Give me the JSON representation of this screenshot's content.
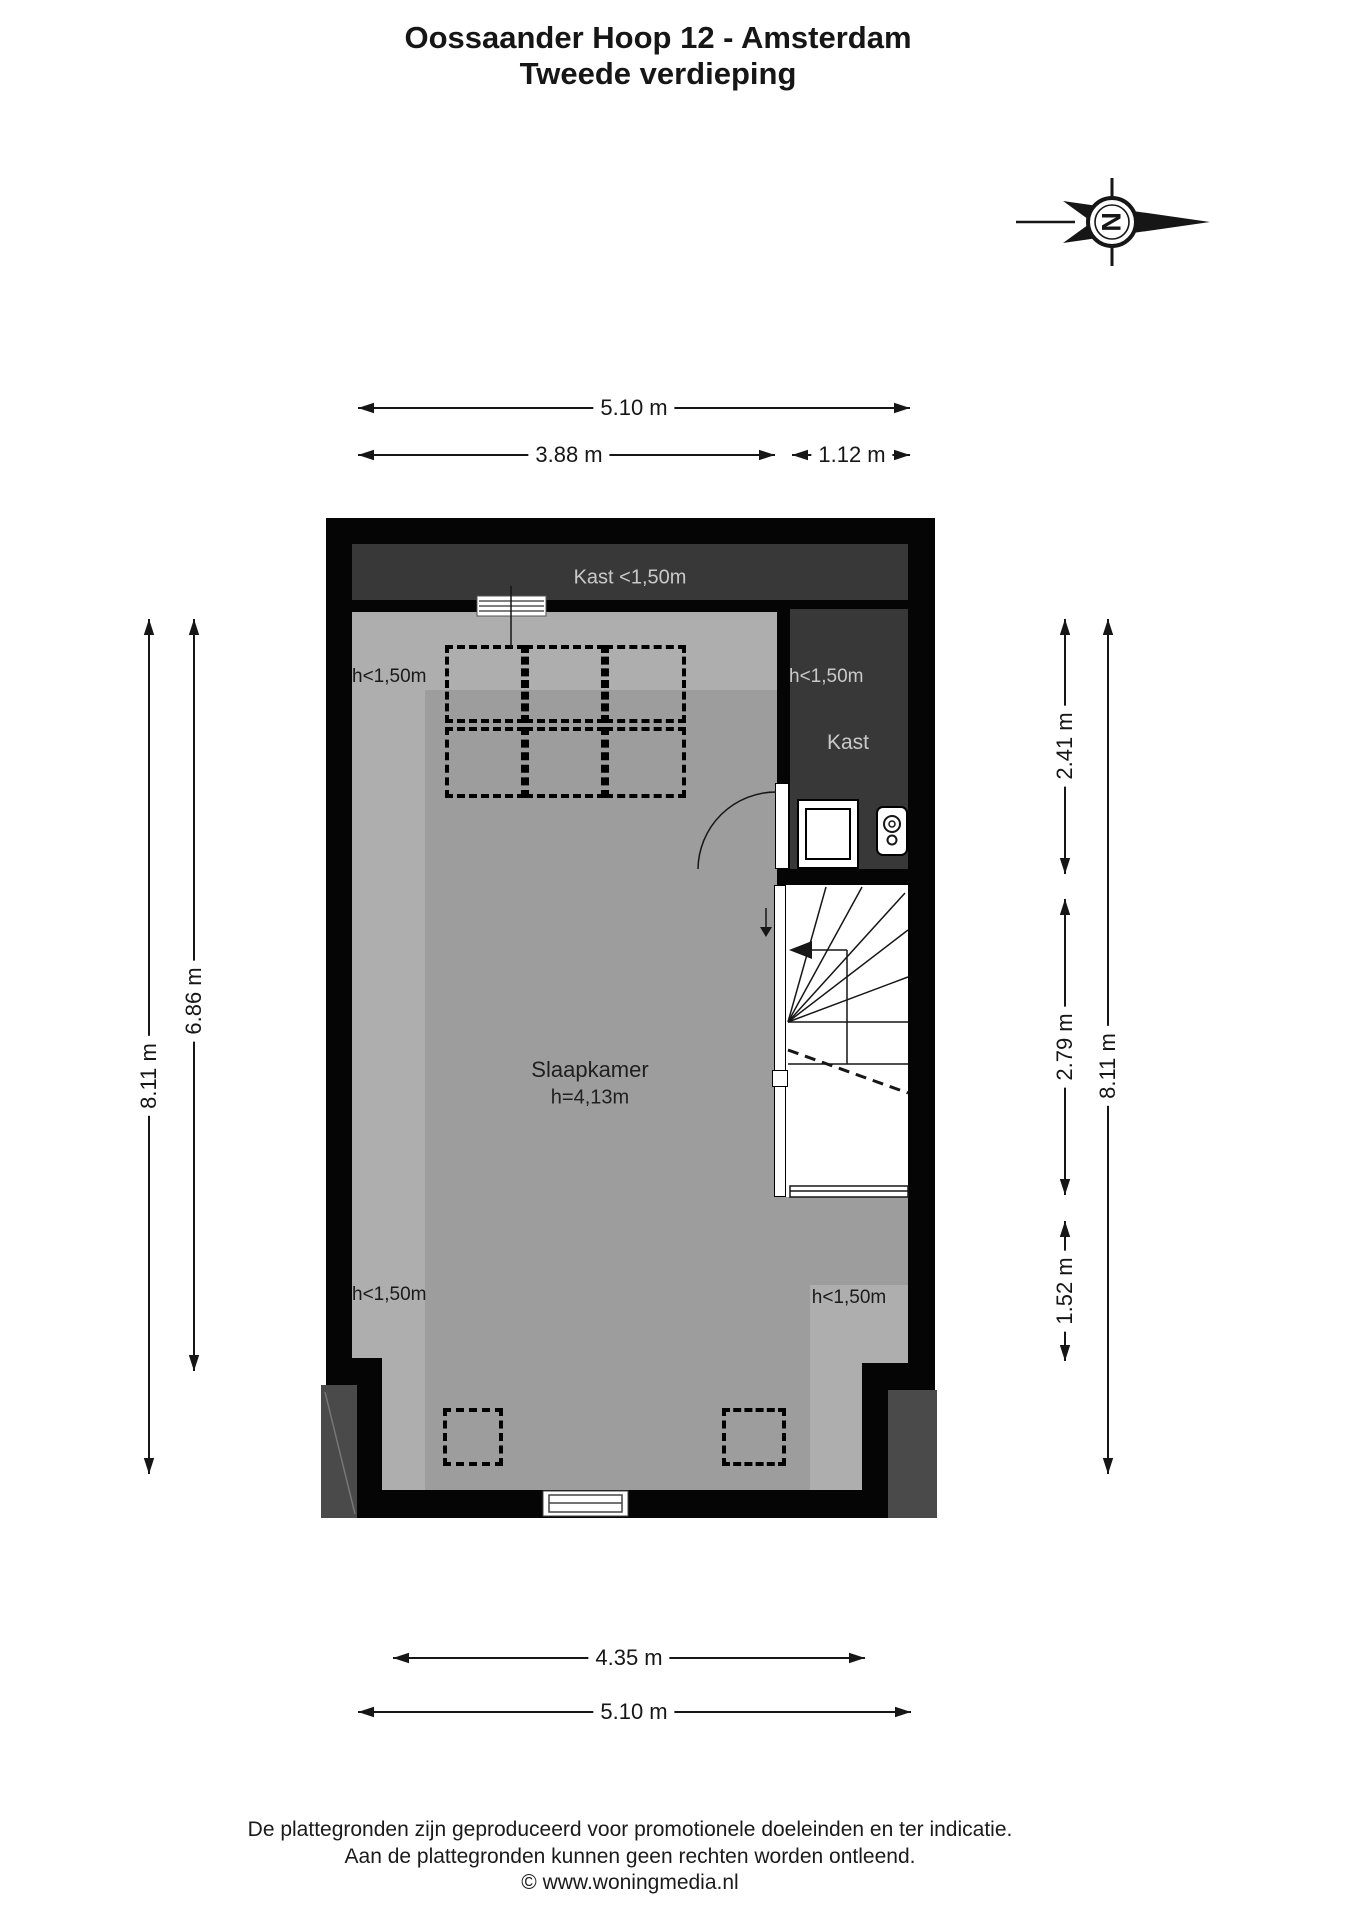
{
  "title": {
    "line1": "Oossaander Hoop 12 - Amsterdam",
    "line2": "Tweede verdieping"
  },
  "compass": {
    "direction_letter": "N"
  },
  "plan": {
    "top_closet_label": "Kast <1,50m",
    "closet_label": "Kast",
    "bedroom_label": "Slaapkamer",
    "bedroom_height_label": "h=4,13m",
    "low_height_labels": {
      "top_left": "h<1,50m",
      "closet": "h<1,50m",
      "bottom_left": "h<1,50m",
      "bottom_right": "h<1,50m"
    }
  },
  "dimensions": {
    "top": [
      {
        "label": "5.10 m"
      },
      {
        "label": "3.88 m"
      },
      {
        "label": "1.12 m"
      }
    ],
    "bottom": [
      {
        "label": "4.35 m"
      },
      {
        "label": "5.10 m"
      }
    ],
    "left": [
      {
        "label": "8.11 m"
      },
      {
        "label": "6.86 m"
      }
    ],
    "right": [
      {
        "label": "2.41 m"
      },
      {
        "label": "2.79 m"
      },
      {
        "label": "1.52 m"
      },
      {
        "label": "8.11 m"
      }
    ]
  },
  "footer": {
    "line1": "De plattegronden zijn geproduceerd voor promotionele doeleinden en ter indicatie.",
    "line2": "Aan de plattegronden kunnen geen rechten worden ontleend.",
    "line3": "© www.woningmedia.nl"
  },
  "colors": {
    "wall": "#050505",
    "floor": "#9d9d9d",
    "floor-light": "#aeaeae",
    "closet-floor": "#383838",
    "closet-text": "#c9c9c9",
    "exterior": "#4a4a4a",
    "line": "#161616"
  }
}
